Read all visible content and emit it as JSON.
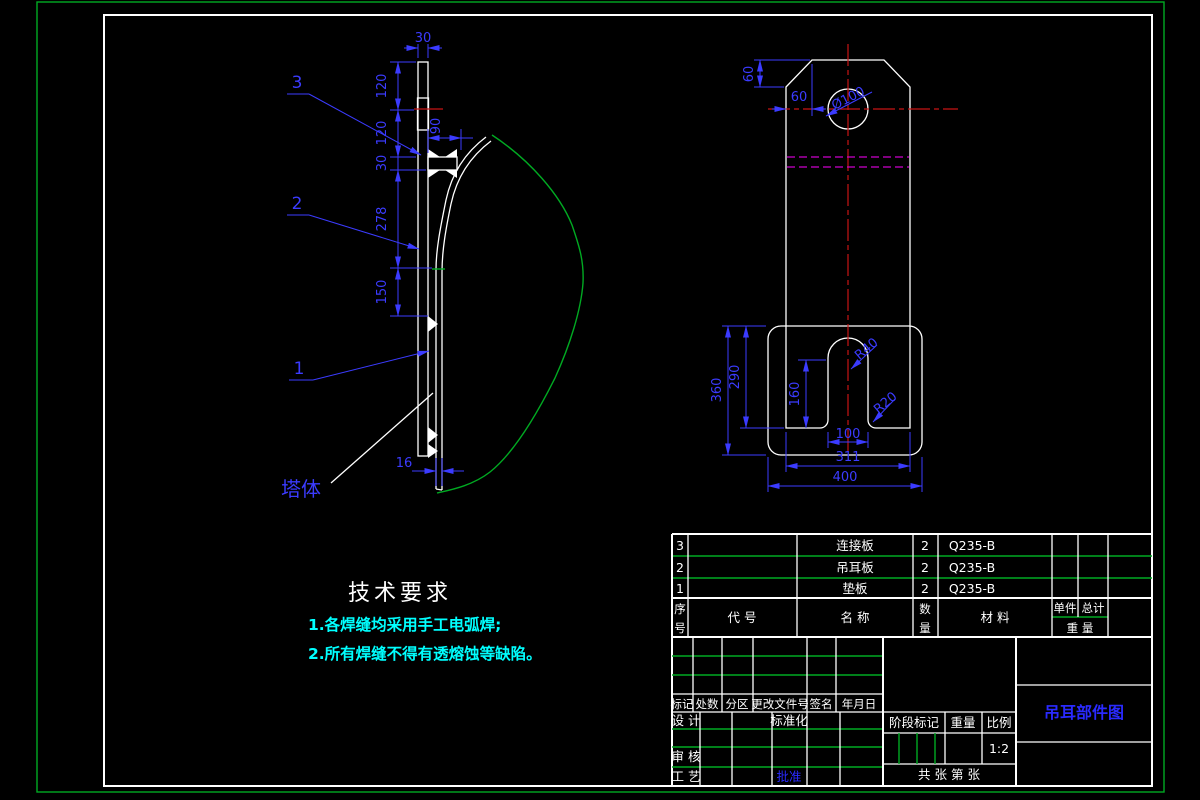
{
  "tech": {
    "title": "技术要求",
    "item1": "1.各焊缝均采用手工电弧焊;",
    "item2": "2.所有焊缝不得有透熔蚀等缺陷。"
  },
  "left_view": {
    "label_3": "3",
    "label_2": "2",
    "label_1": "1",
    "label_tower": "塔体",
    "dim_top_width": "30",
    "dim_120a": "120",
    "dim_120b": "120",
    "dim_30": "30",
    "dim_278": "278",
    "dim_150": "150",
    "dim_16": "16",
    "dim_90": "90"
  },
  "right_view": {
    "dim_60v": "60",
    "dim_60h": "60",
    "dim_hole": "Ø100",
    "dim_r40": "R40",
    "dim_r20": "R20",
    "dim_160": "160",
    "dim_290": "290",
    "dim_360": "360",
    "dim_100": "100",
    "dim_311": "311",
    "dim_400": "400"
  },
  "bom": {
    "rows": [
      {
        "no": "3",
        "code": "",
        "name": "连接板",
        "qty": "2",
        "material": "Q235-B"
      },
      {
        "no": "2",
        "code": "",
        "name": "吊耳板",
        "qty": "2",
        "material": "Q235-B"
      },
      {
        "no": "1",
        "code": "",
        "name": "垫板",
        "qty": "2",
        "material": "Q235-B"
      }
    ],
    "header": {
      "no_top": "序",
      "no_bottom": "号",
      "code": "代  号",
      "name": "名  称",
      "qty_top": "数",
      "qty_bottom": "量",
      "material": "材  料",
      "unit": "单件",
      "total": "总计",
      "weight": "重 量"
    }
  },
  "titleblock": {
    "rev_headers": [
      "标记",
      "处数",
      "分区",
      "更改文件号",
      "签名",
      "年月日"
    ],
    "design": "设 计",
    "standardization": "标准化",
    "check": "审 核",
    "process": "工 艺",
    "approve": "批准",
    "stage": "阶段标记",
    "weight": "重量",
    "scale": "比例",
    "scale_value": "1:2",
    "sheets": "共  张  第  张",
    "title": "吊耳部件图"
  },
  "colors": {
    "dim_blue": "#3b3bff",
    "line_white": "#ffffff",
    "border_green": "#00aa22",
    "centerline_red": "#c81414",
    "hidden_magenta": "#cc00cc",
    "tech_cyan": "#00ffff",
    "background": "#000000"
  }
}
